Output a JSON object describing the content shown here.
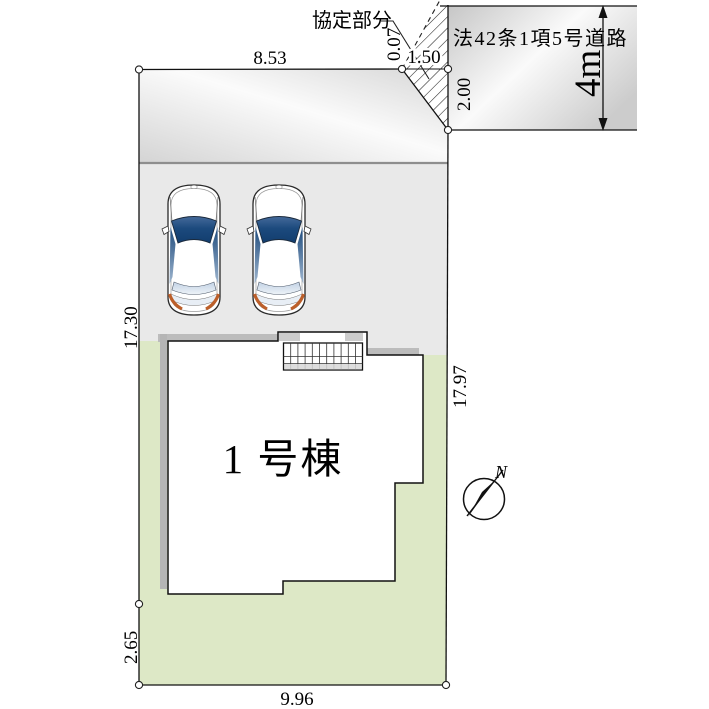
{
  "plan": {
    "labels": {
      "building": "1 号棟",
      "agreement": "協定部分",
      "road": "法42条1項5号道路",
      "road_width": "4m",
      "north": "N"
    },
    "dimensions": {
      "top_width": "8.53",
      "offset": "0.07",
      "agreement_width": "1.50",
      "agreement_depth": "2.00",
      "left_upper": "17.30",
      "right_side": "17.97",
      "left_lower": "2.65",
      "bottom_width": "9.96"
    },
    "colors": {
      "lot_green": "#dde8c6",
      "parking_gray": "#e9e9e9",
      "road_gray_dark": "#c6c6c6",
      "road_gray_light": "#fafafa",
      "shadow_gray": "#bcbcbc",
      "windshield_blue": "#123d6e",
      "taillight_orange": "#bc5f2a"
    }
  }
}
